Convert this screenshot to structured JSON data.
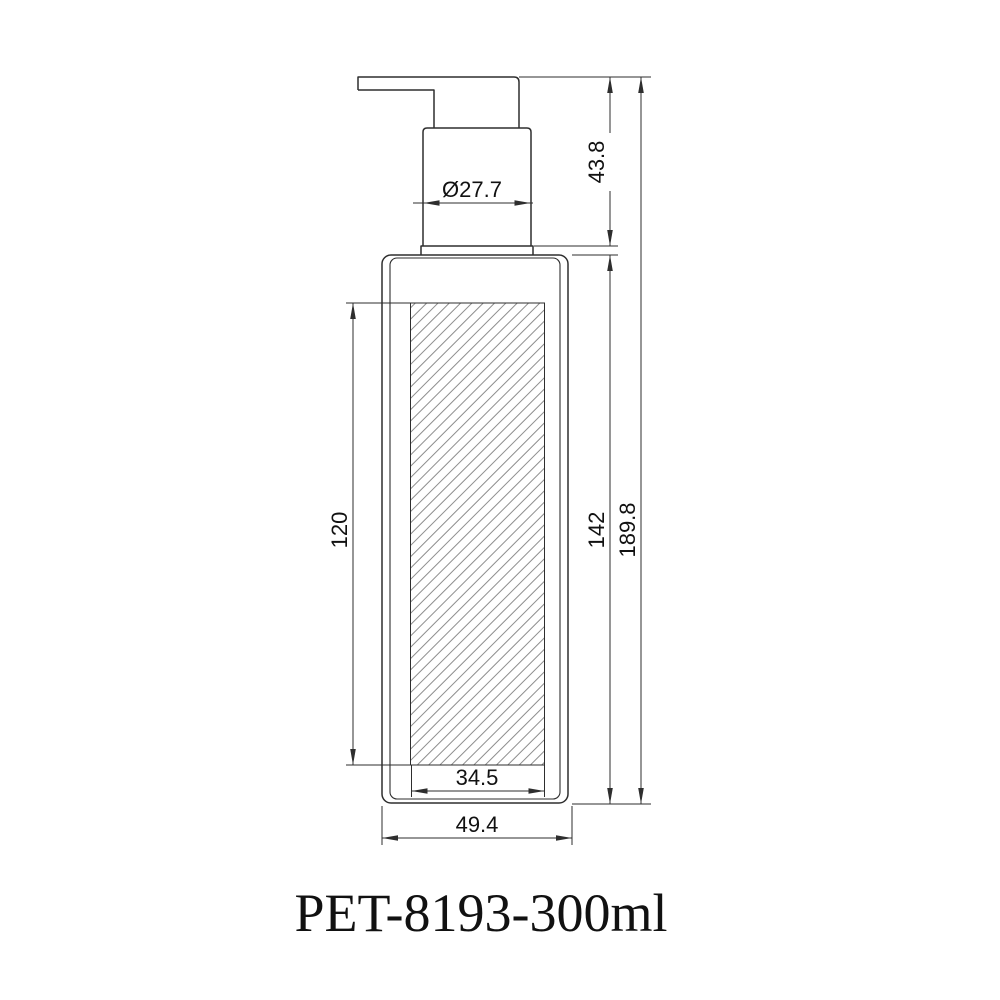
{
  "drawing": {
    "title": "PET-8193-300ml",
    "dimensions": {
      "pump_diameter": "Ø27.7",
      "pump_height": "43.8",
      "label_panel_height": "120",
      "body_height": "142",
      "total_height": "189.8",
      "label_panel_width": "34.5",
      "body_width": "49.4"
    },
    "colors": {
      "background": "#ffffff",
      "line": "#2e2e2e",
      "hatch": "#8d8d8d",
      "text": "#111111"
    }
  }
}
